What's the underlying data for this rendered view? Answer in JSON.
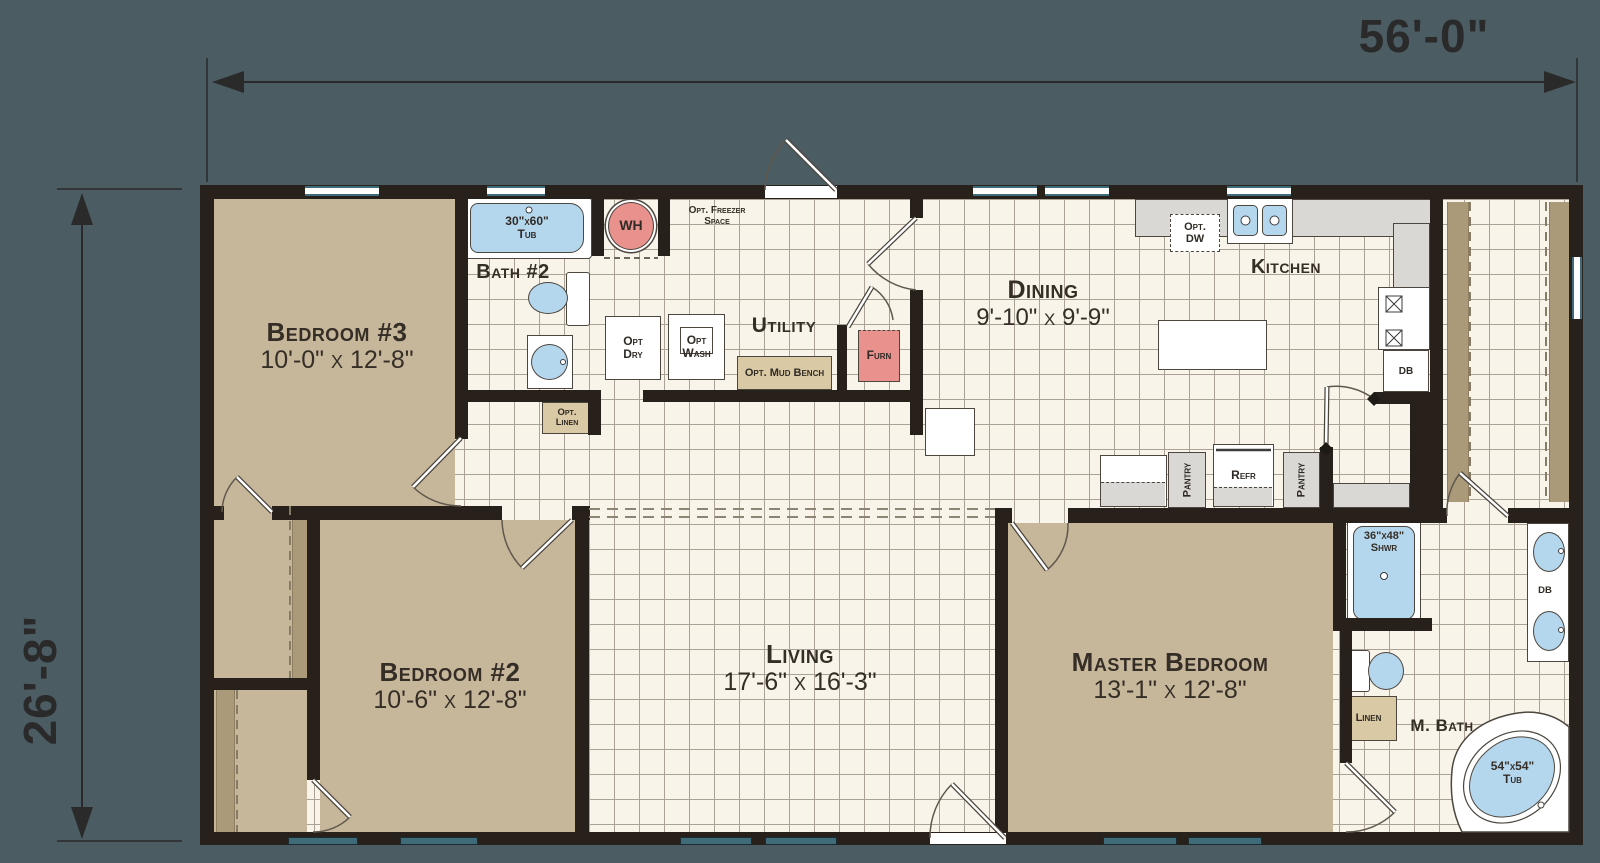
{
  "dimensions": {
    "width": "56'-0\"",
    "height": "26'-8\""
  },
  "rooms": {
    "bedroom3": {
      "name": "Bedroom #3",
      "size": "10'-0\" x 12'-8\""
    },
    "bedroom2": {
      "name": "Bedroom #2",
      "size": "10'-6\" x 12'-8\""
    },
    "living": {
      "name": "Living",
      "size": "17'-6\" x 16'-3\""
    },
    "dining": {
      "name": "Dining",
      "size": "9'-10\" x 9'-9\""
    },
    "master": {
      "name": "Master Bedroom",
      "size": "13'-1\" x 12'-8\""
    },
    "kitchen": {
      "name": "Kitchen"
    },
    "utility": {
      "name": "Utility"
    },
    "bath2": {
      "name": "Bath #2"
    },
    "mbath": {
      "name": "M. Bath"
    }
  },
  "fixtures": {
    "tub30": {
      "l1": "30\"x60\"",
      "l2": "Tub"
    },
    "wh": "WH",
    "freezer": {
      "l1": "Opt. Freezer",
      "l2": "Space"
    },
    "dry": {
      "l1": "Opt",
      "l2": "Dry"
    },
    "wash": {
      "l1": "Opt",
      "l2": "Wash"
    },
    "mudbench": "Opt. Mud Bench",
    "furn": "Furn",
    "optlinen": {
      "l1": "Opt.",
      "l2": "Linen"
    },
    "dw": {
      "l1": "Opt.",
      "l2": "DW"
    },
    "pantry1": "Pantry",
    "pantry2": "Pantry",
    "refr": "Refr",
    "db_kitchen": "DB",
    "db_bath": "DB",
    "shower": {
      "l1": "36\"x48\"",
      "l2": "Shwr"
    },
    "linen": "Linen",
    "tub54": {
      "l1": "54\"x54\"",
      "l2": "Tub"
    }
  },
  "colors": {
    "background": "#4b5c63",
    "wall": "#28211b",
    "carpet_tan": "#c6b69a",
    "tile_cream": "#f8f4e9",
    "fixture_blue": "#b5d7ee",
    "fixture_pink": "#e8918d",
    "counter_gray": "#d9d8d5",
    "window_teal": "#3f6c78"
  }
}
